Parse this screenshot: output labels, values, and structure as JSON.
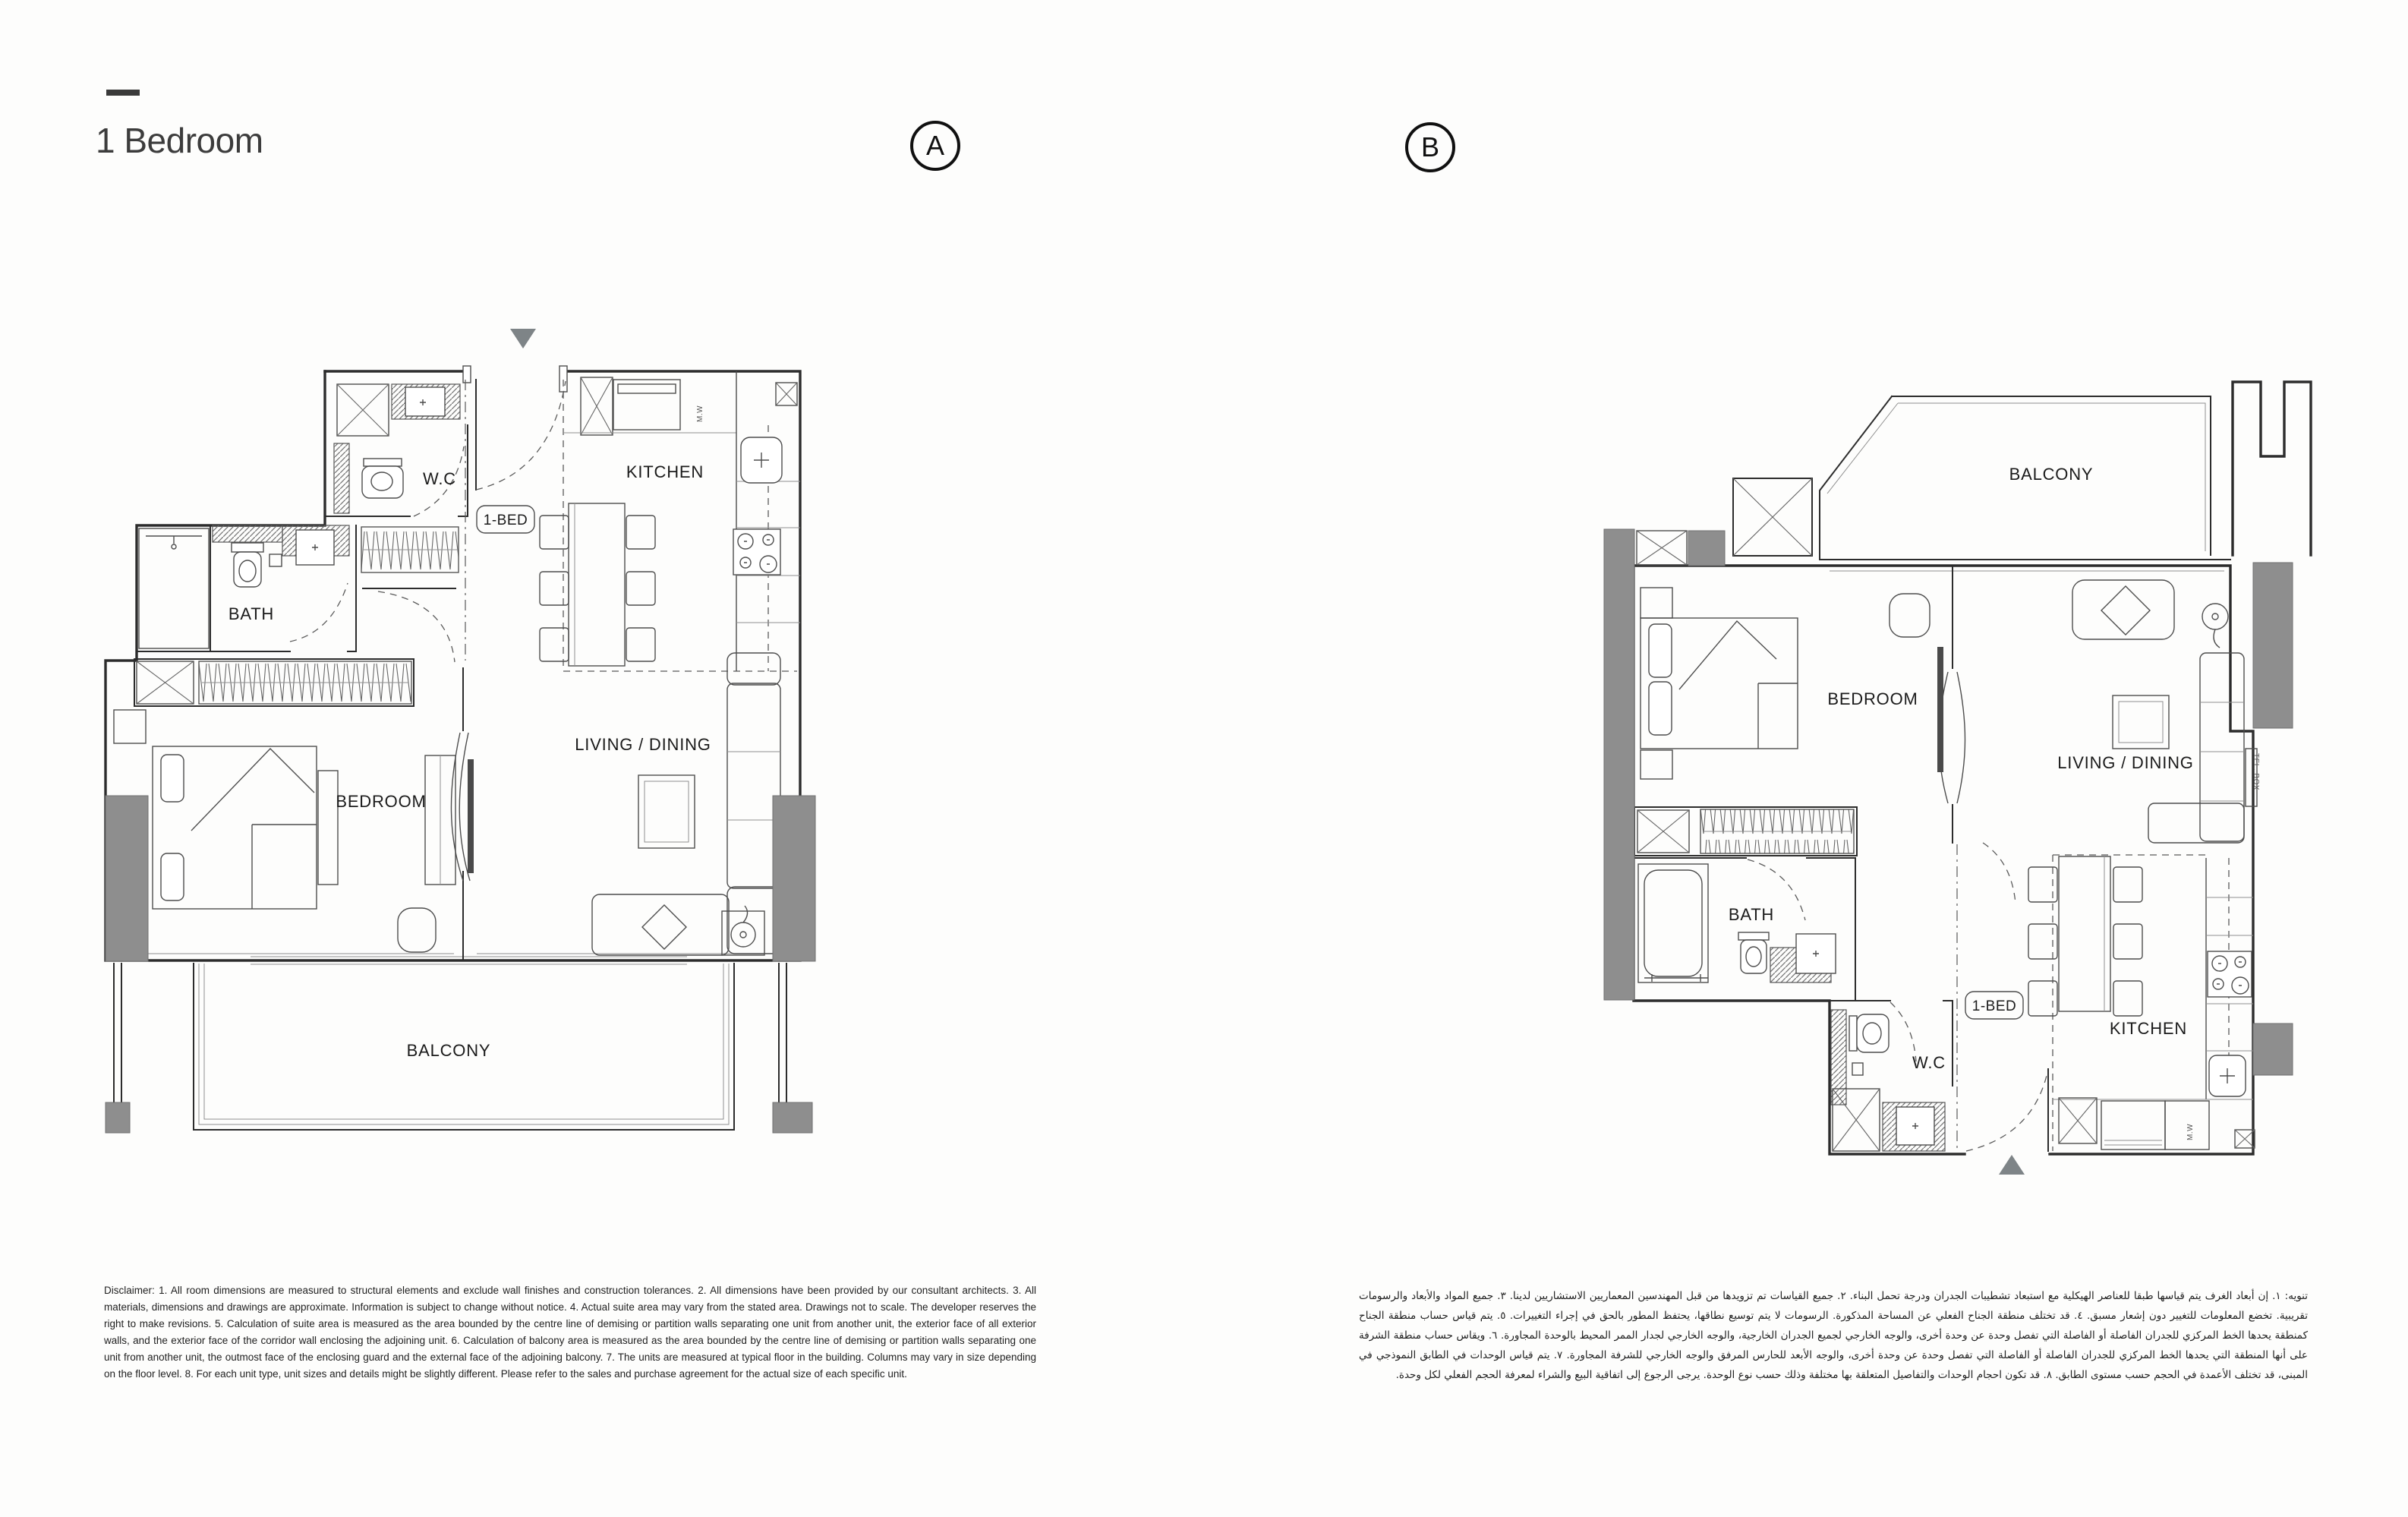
{
  "header": {
    "title": "1 Bedroom"
  },
  "plan_a": {
    "marker": "A",
    "labels": {
      "wc": "W.C",
      "kitchen": "KITCHEN",
      "microwave": "M.W",
      "unit_type": "1-BED",
      "bath": "BATH",
      "bedroom": "BEDROOM",
      "living_dining": "LIVING / DINING",
      "balcony": "BALCONY"
    }
  },
  "plan_b": {
    "marker": "B",
    "labels": {
      "balcony": "BALCONY",
      "bedroom": "BEDROOM",
      "living_dining": "LIVING / DINING",
      "tel_box": "TEL. BOX",
      "bath": "BATH",
      "wc": "W.C",
      "unit_type": "1-BED",
      "kitchen": "KITCHEN",
      "microwave": "M.W"
    }
  },
  "disclaimer_en": "Disclaimer: 1. All room dimensions are measured to structural elements and exclude wall finishes and construction tolerances. 2. All dimensions have been provided by our consultant architects. 3. All materials, dimensions and drawings are approximate. Information is subject to change without notice. 4. Actual suite area may vary from the stated area. Drawings not to scale. The developer reserves the right to make revisions. 5. Calculation of suite area is measured as the area bounded by the centre line of demising or partition walls separating one unit from another unit, the exterior face of all exterior walls, and the exterior face of the corridor wall enclosing the adjoining unit. 6. Calculation of balcony area is measured as the area bounded by the centre line of demising or partition walls separating one unit from another unit, the outmost face of the enclosing guard and the external face of the adjoining balcony. 7. The units are measured at typical floor in the building. Columns may vary in size depending on the floor level. 8. For each unit type, unit sizes and details might be slightly different. Please refer to the sales and purchase agreement for the actual size of each specific unit.",
  "disclaimer_ar": "تنويه: ١. إن أبعاد الغرف يتم قياسها طبقا للعناصر الهيكلية مع استبعاد تشطيبات الجدران ودرجة تحمل البناء. ٢. جميع القياسات تم تزويدها من قبل المهندسين المعماريين الاستشاريين لدينا. ٣. جميع المواد والأبعاد والرسومات تقريبية. تخضع المعلومات للتغيير دون إشعار مسبق. ٤. قد تختلف منطقة الجناح الفعلي عن المساحة المذكورة. الرسومات لا يتم توسيع نطاقها، يحتفظ المطور بالحق في إجراء التغييرات. ٥. يتم قياس حساب منطقة الجناح كمنطقة يحدها الخط المركزي للجدران الفاصلة أو الفاصلة التي تفصل وحدة عن وحدة أخرى، والوجه الخارجي لجميع الجدران الخارجية، والوجه الخارجي لجدار الممر المحيط بالوحدة المجاورة. ٦. ويقاس حساب منطقة الشرفة على أنها المنطقة التي يحدها الخط المركزي للجدران الفاصلة أو الفاصلة التي تفصل وحدة عن وحدة أخرى، والوجه الأبعد للحارس المرفق والوجه الخارجي للشرفة المجاورة. ٧. يتم قياس الوحدات في الطابق النموذجي في المبنى، قد تختلف الأعمدة في الحجم حسب مستوى الطابق. ٨. قد تكون احجام الوحدات والتفاصيل المتعلقة بها مختلفة وذلك حسب نوع الوحدة. يرجى الرجوع إلى اتفاقية البيع والشراء لمعرفة الحجم الفعلي لكل وحدة.",
  "colors": {
    "line": "#2c2c2c",
    "structure_gray": "#8e8e8e",
    "marker_gray": "#7e8487",
    "text": "#1f1f1f"
  }
}
